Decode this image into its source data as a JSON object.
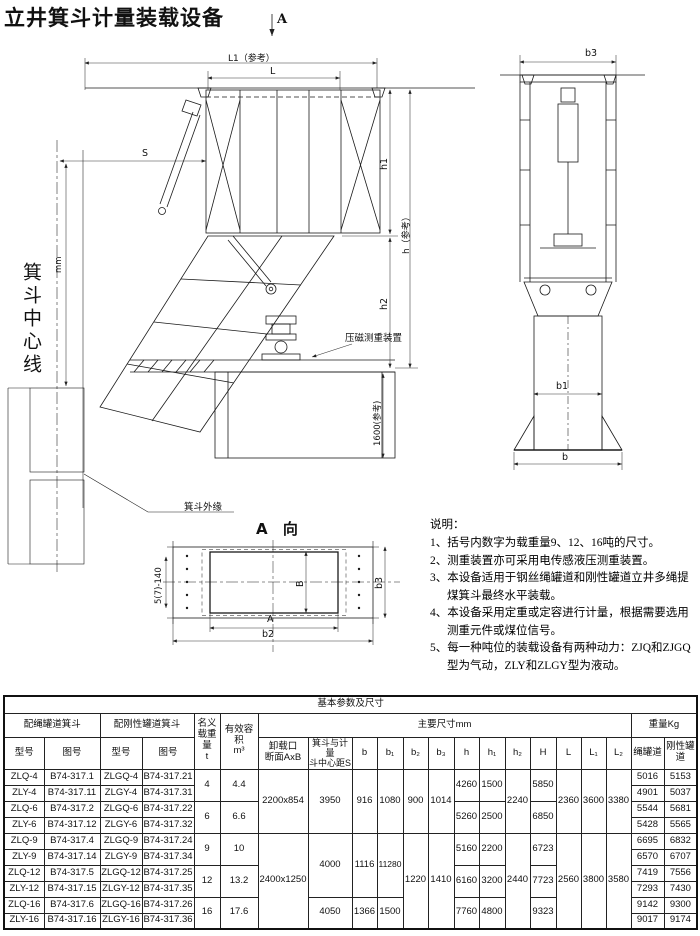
{
  "page": {
    "title": "立井箕斗计量装载设备"
  },
  "drawing": {
    "section_arrow": "A",
    "dim_l1": "L1（参考）",
    "dim_l": "L",
    "dim_s": "S",
    "dim_mm": "mm",
    "dim_h1": "h1",
    "dim_h2": "h2",
    "dim_h_ref": "h（参考）",
    "dim_1600": "1600(参考)",
    "weigher_label": "压磁测重装置",
    "centerline_label": "箕斗中心线",
    "skip_edge_label": "箕斗外缘",
    "view_a_title": "A 向",
    "dim_holes": "5(7)-140",
    "dim_B": "B",
    "dim_b3_view": "b3",
    "dim_A": "A",
    "dim_b2": "b2",
    "dim_b3": "b3",
    "dim_b1": "b1",
    "dim_b": "b"
  },
  "notes": {
    "heading": "说明：",
    "items": [
      "1、括号内数字为载重量9、12、16吨的尺寸。",
      "2、测重装置亦可采用电传感液压测重装置。",
      "3、本设备适用于钢丝绳罐道和刚性罐道立井多绳提煤箕斗最终水平装载。",
      "4、本设备采用定重或定容进行计量，根据需要选用测重元件或煤位信号。",
      "5、每一种吨位的装载设备有两种动力：ZJQ和ZJGQ型为气动，ZLY和ZLGY型为液动。"
    ]
  },
  "table": {
    "title": "基本参数及尺寸",
    "header": {
      "rope_group": "配绳罐道箕斗",
      "rigid_group": "配刚性罐道箕斗",
      "model": "型号",
      "drawing_no": "图号",
      "load": "名义\n载重量\nt",
      "volume": "有效容积\nm³",
      "main_dims": "主要尺寸mm",
      "outlet": "卸载口\n断面AxB",
      "center_s": "箕斗与计量\n斗中心距S",
      "dims": [
        "b",
        "b₁",
        "b₂",
        "b₃",
        "h",
        "h₁",
        "h₂",
        "H",
        "L",
        "L₁",
        "L₂"
      ],
      "weight": "重量Kg",
      "w_rope": "绳罐道",
      "w_rigid": "刚性罐道"
    },
    "rows": [
      [
        "ZLQ-4",
        "B74-317.1",
        "ZLGQ-4",
        "B74-317.21",
        "4",
        "4.4",
        "2200x854",
        "3950",
        "916",
        "1080",
        "900",
        "1014",
        "4260",
        "1500",
        "2240",
        "5850",
        "2360",
        "3600",
        "3380",
        "5016",
        "5153"
      ],
      [
        "ZLY-4",
        "B74-317.11",
        "ZLGY-4",
        "B74-317.31",
        "4901",
        "5037"
      ],
      [
        "ZLQ-6",
        "B74-317.2",
        "ZLGQ-6",
        "B74-317.22",
        "6",
        "6.6",
        "5260",
        "2500",
        "6850",
        "5544",
        "5681"
      ],
      [
        "ZLY-6",
        "B74-317.12",
        "ZLGY-6",
        "B74-317.32",
        "5428",
        "5565"
      ],
      [
        "ZLQ-9",
        "B74-317.4",
        "ZLGQ-9",
        "B74-317.24",
        "9",
        "10",
        "2400x1250",
        "4000",
        "1116",
        "11280",
        "1220",
        "1410",
        "5160",
        "2200",
        "2440",
        "6723",
        "2560",
        "3800",
        "3580",
        "6695",
        "6832"
      ],
      [
        "ZLY-9",
        "B74-317.14",
        "ZLGY-9",
        "B74-317.34",
        "6570",
        "6707"
      ],
      [
        "ZLQ-12",
        "B74-317.5",
        "ZLGQ-12",
        "B74-317.25",
        "12",
        "13.2",
        "6160",
        "3200",
        "7723",
        "7419",
        "7556"
      ],
      [
        "ZLY-12",
        "B74-317.15",
        "ZLGY-12",
        "B74-317.35",
        "7293",
        "7430"
      ],
      [
        "ZLQ-16",
        "B74-317.6",
        "ZLGQ-16",
        "B74-317.26",
        "16",
        "17.6",
        "4050",
        "1366",
        "1500",
        "7760",
        "4800",
        "9323",
        "9142",
        "9300"
      ],
      [
        "ZLY-16",
        "B74-317.16",
        "ZLGY-16",
        "B74-317.36",
        "9017",
        "9174"
      ]
    ]
  }
}
